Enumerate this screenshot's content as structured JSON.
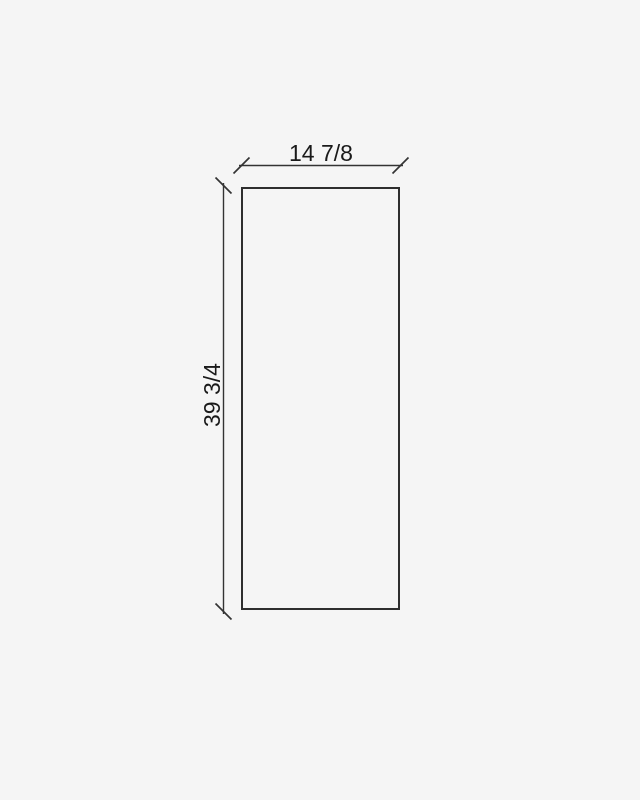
{
  "drawing": {
    "type": "panel-dimension-diagram",
    "width_dimension": {
      "label": "14 7/8"
    },
    "height_dimension": {
      "label": "39 3/4"
    },
    "colors": {
      "background": "#f5f5f5",
      "outline": "#2e2e2e",
      "dimension_line": "#333333",
      "text": "#1a1a1a"
    }
  }
}
